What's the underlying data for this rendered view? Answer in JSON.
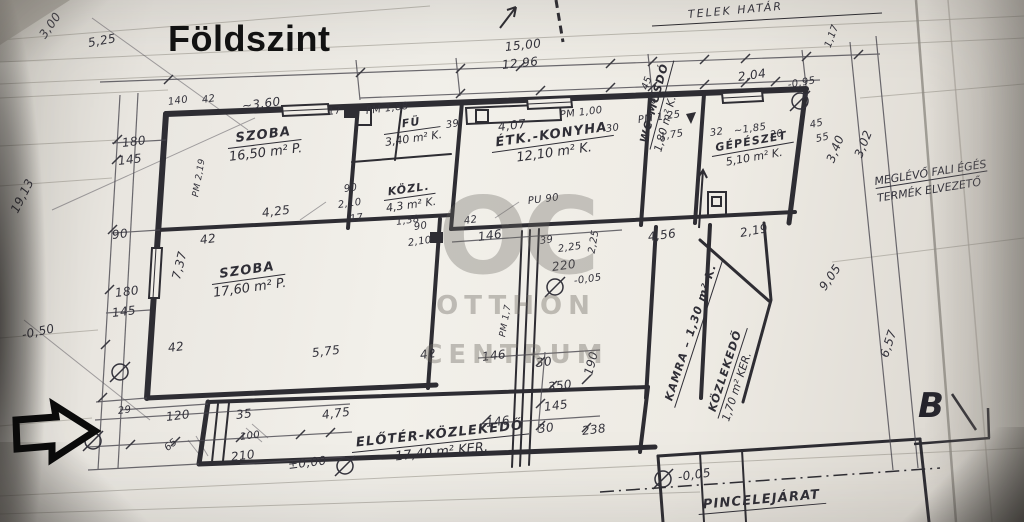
{
  "title": {
    "text": "Földszint"
  },
  "watermark": {
    "monogram": "OC",
    "line1": "OTTHON",
    "line2": "CENTRUM"
  },
  "notes": {
    "boundary": "TELEK HATÁR",
    "flue_line1": "MEGLÉVŐ FALI ÉGÉS",
    "flue_line2": "TERMÉK ELVEZETŐ",
    "section_mark": "B"
  },
  "rooms": [
    {
      "name": "SZOBA",
      "area": "16,50 m² P."
    },
    {
      "name": "SZOBA",
      "area": "17,60 m² P."
    },
    {
      "name": "ÉTK.-KONYHA",
      "area": "12,10 m² K."
    },
    {
      "name": "FÜ",
      "area": "3,40 m² K."
    },
    {
      "name": "KÖZL.",
      "area": "4,3 m² K."
    },
    {
      "name": "GÉPÉSZET",
      "area": "5,10 m² K."
    },
    {
      "name": "WC–MOSDÓ",
      "area": "1,80 m² K."
    },
    {
      "name": "KAMRA – 1,30 m² K.",
      "area": ""
    },
    {
      "name": "KÖZLEKEDŐ",
      "area": "1,70 m² KER."
    },
    {
      "name": "ELŐTÉR-KÖZLEKEDŐ",
      "area": "17,40 m² KER."
    },
    {
      "name": "PINCELEJÁRAT",
      "area": ""
    }
  ],
  "dimensions": [
    {
      "t": "3,00",
      "x": 42,
      "y": 30,
      "r": -55
    },
    {
      "t": "5,25",
      "x": 88,
      "y": 36,
      "r": -10
    },
    {
      "t": "19,13",
      "x": 14,
      "y": 205,
      "r": -63
    },
    {
      "t": "-0,50",
      "x": 22,
      "y": 328,
      "r": -12
    },
    {
      "t": "140",
      "x": 168,
      "y": 97,
      "r": -8,
      "fs": 10
    },
    {
      "t": "42",
      "x": 202,
      "y": 95,
      "r": -8,
      "fs": 10
    },
    {
      "t": "~3,60",
      "x": 242,
      "y": 99,
      "r": -7
    },
    {
      "t": "17",
      "x": 328,
      "y": 107,
      "r": -8,
      "fs": 10
    },
    {
      "t": "PM 1,88",
      "x": 366,
      "y": 106,
      "r": -7,
      "fs": 10
    },
    {
      "t": "15,00",
      "x": 505,
      "y": 40,
      "r": -6
    },
    {
      "t": "12,96",
      "x": 502,
      "y": 58,
      "r": -6
    },
    {
      "t": "4,07",
      "x": 498,
      "y": 120,
      "r": -7
    },
    {
      "t": "PM 1,00",
      "x": 560,
      "y": 110,
      "r": -7,
      "fs": 10
    },
    {
      "t": "30",
      "x": 606,
      "y": 124,
      "r": -8,
      "fs": 10
    },
    {
      "t": "PM 1,25",
      "x": 638,
      "y": 115,
      "r": -8,
      "fs": 10
    },
    {
      "t": "1,75",
      "x": 660,
      "y": 132,
      "r": -10,
      "fs": 10
    },
    {
      "t": "45",
      "x": 645,
      "y": 84,
      "r": -70,
      "fs": 10
    },
    {
      "t": "85",
      "x": 652,
      "y": 98,
      "r": -70,
      "fs": 10
    },
    {
      "t": "2,04",
      "x": 738,
      "y": 70,
      "r": -8
    },
    {
      "t": "1,17",
      "x": 828,
      "y": 42,
      "r": -70,
      "fs": 10
    },
    {
      "t": "-0,95",
      "x": 788,
      "y": 80,
      "r": -10,
      "fs": 10
    },
    {
      "t": "32",
      "x": 710,
      "y": 128,
      "r": -8,
      "fs": 10
    },
    {
      "t": "~1,85",
      "x": 734,
      "y": 126,
      "r": -8,
      "fs": 10
    },
    {
      "t": "20",
      "x": 770,
      "y": 130,
      "r": -8,
      "fs": 10
    },
    {
      "t": "45",
      "x": 810,
      "y": 120,
      "r": -12,
      "fs": 10
    },
    {
      "t": "55",
      "x": 816,
      "y": 134,
      "r": -12,
      "fs": 10
    },
    {
      "t": "3,40",
      "x": 830,
      "y": 155,
      "r": -68
    },
    {
      "t": "3,02",
      "x": 858,
      "y": 150,
      "r": -68
    },
    {
      "t": "2,19",
      "x": 740,
      "y": 226,
      "r": -10
    },
    {
      "t": "9,05",
      "x": 822,
      "y": 282,
      "r": -55
    },
    {
      "t": "6,57",
      "x": 884,
      "y": 350,
      "r": -72
    },
    {
      "t": "180",
      "x": 122,
      "y": 136,
      "r": -7
    },
    {
      "t": "145",
      "x": 118,
      "y": 154,
      "r": -7
    },
    {
      "t": "PM 2,19",
      "x": 196,
      "y": 192,
      "r": -80,
      "fs": 9
    },
    {
      "t": "4,25",
      "x": 262,
      "y": 206,
      "r": -7
    },
    {
      "t": "90",
      "x": 112,
      "y": 228,
      "r": -7
    },
    {
      "t": "42",
      "x": 200,
      "y": 233,
      "r": -7
    },
    {
      "t": "7,37",
      "x": 176,
      "y": 272,
      "r": -76
    },
    {
      "t": "180",
      "x": 115,
      "y": 286,
      "r": -7
    },
    {
      "t": "145",
      "x": 112,
      "y": 306,
      "r": -7
    },
    {
      "t": "42",
      "x": 168,
      "y": 341,
      "r": -7
    },
    {
      "t": "5,75",
      "x": 312,
      "y": 346,
      "r": -7
    },
    {
      "t": "42",
      "x": 420,
      "y": 348,
      "r": -7
    },
    {
      "t": "90",
      "x": 344,
      "y": 184,
      "r": -8,
      "fs": 10
    },
    {
      "t": "2,10",
      "x": 338,
      "y": 200,
      "r": -8,
      "fs": 10
    },
    {
      "t": "17",
      "x": 350,
      "y": 214,
      "r": -8,
      "fs": 10
    },
    {
      "t": "1,38",
      "x": 396,
      "y": 217,
      "r": -8,
      "fs": 10
    },
    {
      "t": "90",
      "x": 414,
      "y": 222,
      "r": -8,
      "fs": 10
    },
    {
      "t": "2,10",
      "x": 408,
      "y": 238,
      "r": -8,
      "fs": 10
    },
    {
      "t": "39",
      "x": 446,
      "y": 120,
      "r": -8,
      "fs": 10
    },
    {
      "t": "42",
      "x": 464,
      "y": 216,
      "r": -8,
      "fs": 10
    },
    {
      "t": "146",
      "x": 478,
      "y": 230,
      "r": -8
    },
    {
      "t": "PU 90",
      "x": 528,
      "y": 196,
      "r": -7,
      "fs": 10
    },
    {
      "t": "39",
      "x": 540,
      "y": 236,
      "r": -8,
      "fs": 10
    },
    {
      "t": "2,25",
      "x": 558,
      "y": 244,
      "r": -8,
      "fs": 10
    },
    {
      "t": "220",
      "x": 552,
      "y": 260,
      "r": -8
    },
    {
      "t": "2,25",
      "x": 592,
      "y": 248,
      "r": -80,
      "fs": 10
    },
    {
      "t": "-0,05",
      "x": 574,
      "y": 276,
      "r": -8,
      "fs": 10
    },
    {
      "t": "4,56",
      "x": 648,
      "y": 230,
      "r": -8
    },
    {
      "t": "146",
      "x": 482,
      "y": 350,
      "r": -7
    },
    {
      "t": "PM 1,7",
      "x": 503,
      "y": 332,
      "r": -80,
      "fs": 9
    },
    {
      "t": "30",
      "x": 536,
      "y": 356,
      "r": -7
    },
    {
      "t": "350",
      "x": 548,
      "y": 380,
      "r": -7
    },
    {
      "t": "190",
      "x": 588,
      "y": 368,
      "r": -75
    },
    {
      "t": "145",
      "x": 544,
      "y": 400,
      "r": -7
    },
    {
      "t": "146",
      "x": 486,
      "y": 416,
      "r": -7
    },
    {
      "t": "30",
      "x": 538,
      "y": 422,
      "r": -7
    },
    {
      "t": "238",
      "x": 582,
      "y": 424,
      "r": -7
    },
    {
      "t": "29",
      "x": 118,
      "y": 406,
      "r": -7,
      "fs": 10
    },
    {
      "t": "120",
      "x": 166,
      "y": 410,
      "r": -7
    },
    {
      "t": "35",
      "x": 236,
      "y": 408,
      "r": -7
    },
    {
      "t": "100",
      "x": 240,
      "y": 432,
      "r": -7,
      "fs": 10
    },
    {
      "t": "65",
      "x": 166,
      "y": 444,
      "r": -40,
      "fs": 10
    },
    {
      "t": "210",
      "x": 231,
      "y": 450,
      "r": -7
    },
    {
      "t": "±0,00",
      "x": 288,
      "y": 458,
      "r": -7
    },
    {
      "t": "4,75",
      "x": 322,
      "y": 408,
      "r": -7
    },
    {
      "t": "-0,05",
      "x": 678,
      "y": 470,
      "r": -8
    }
  ]
}
